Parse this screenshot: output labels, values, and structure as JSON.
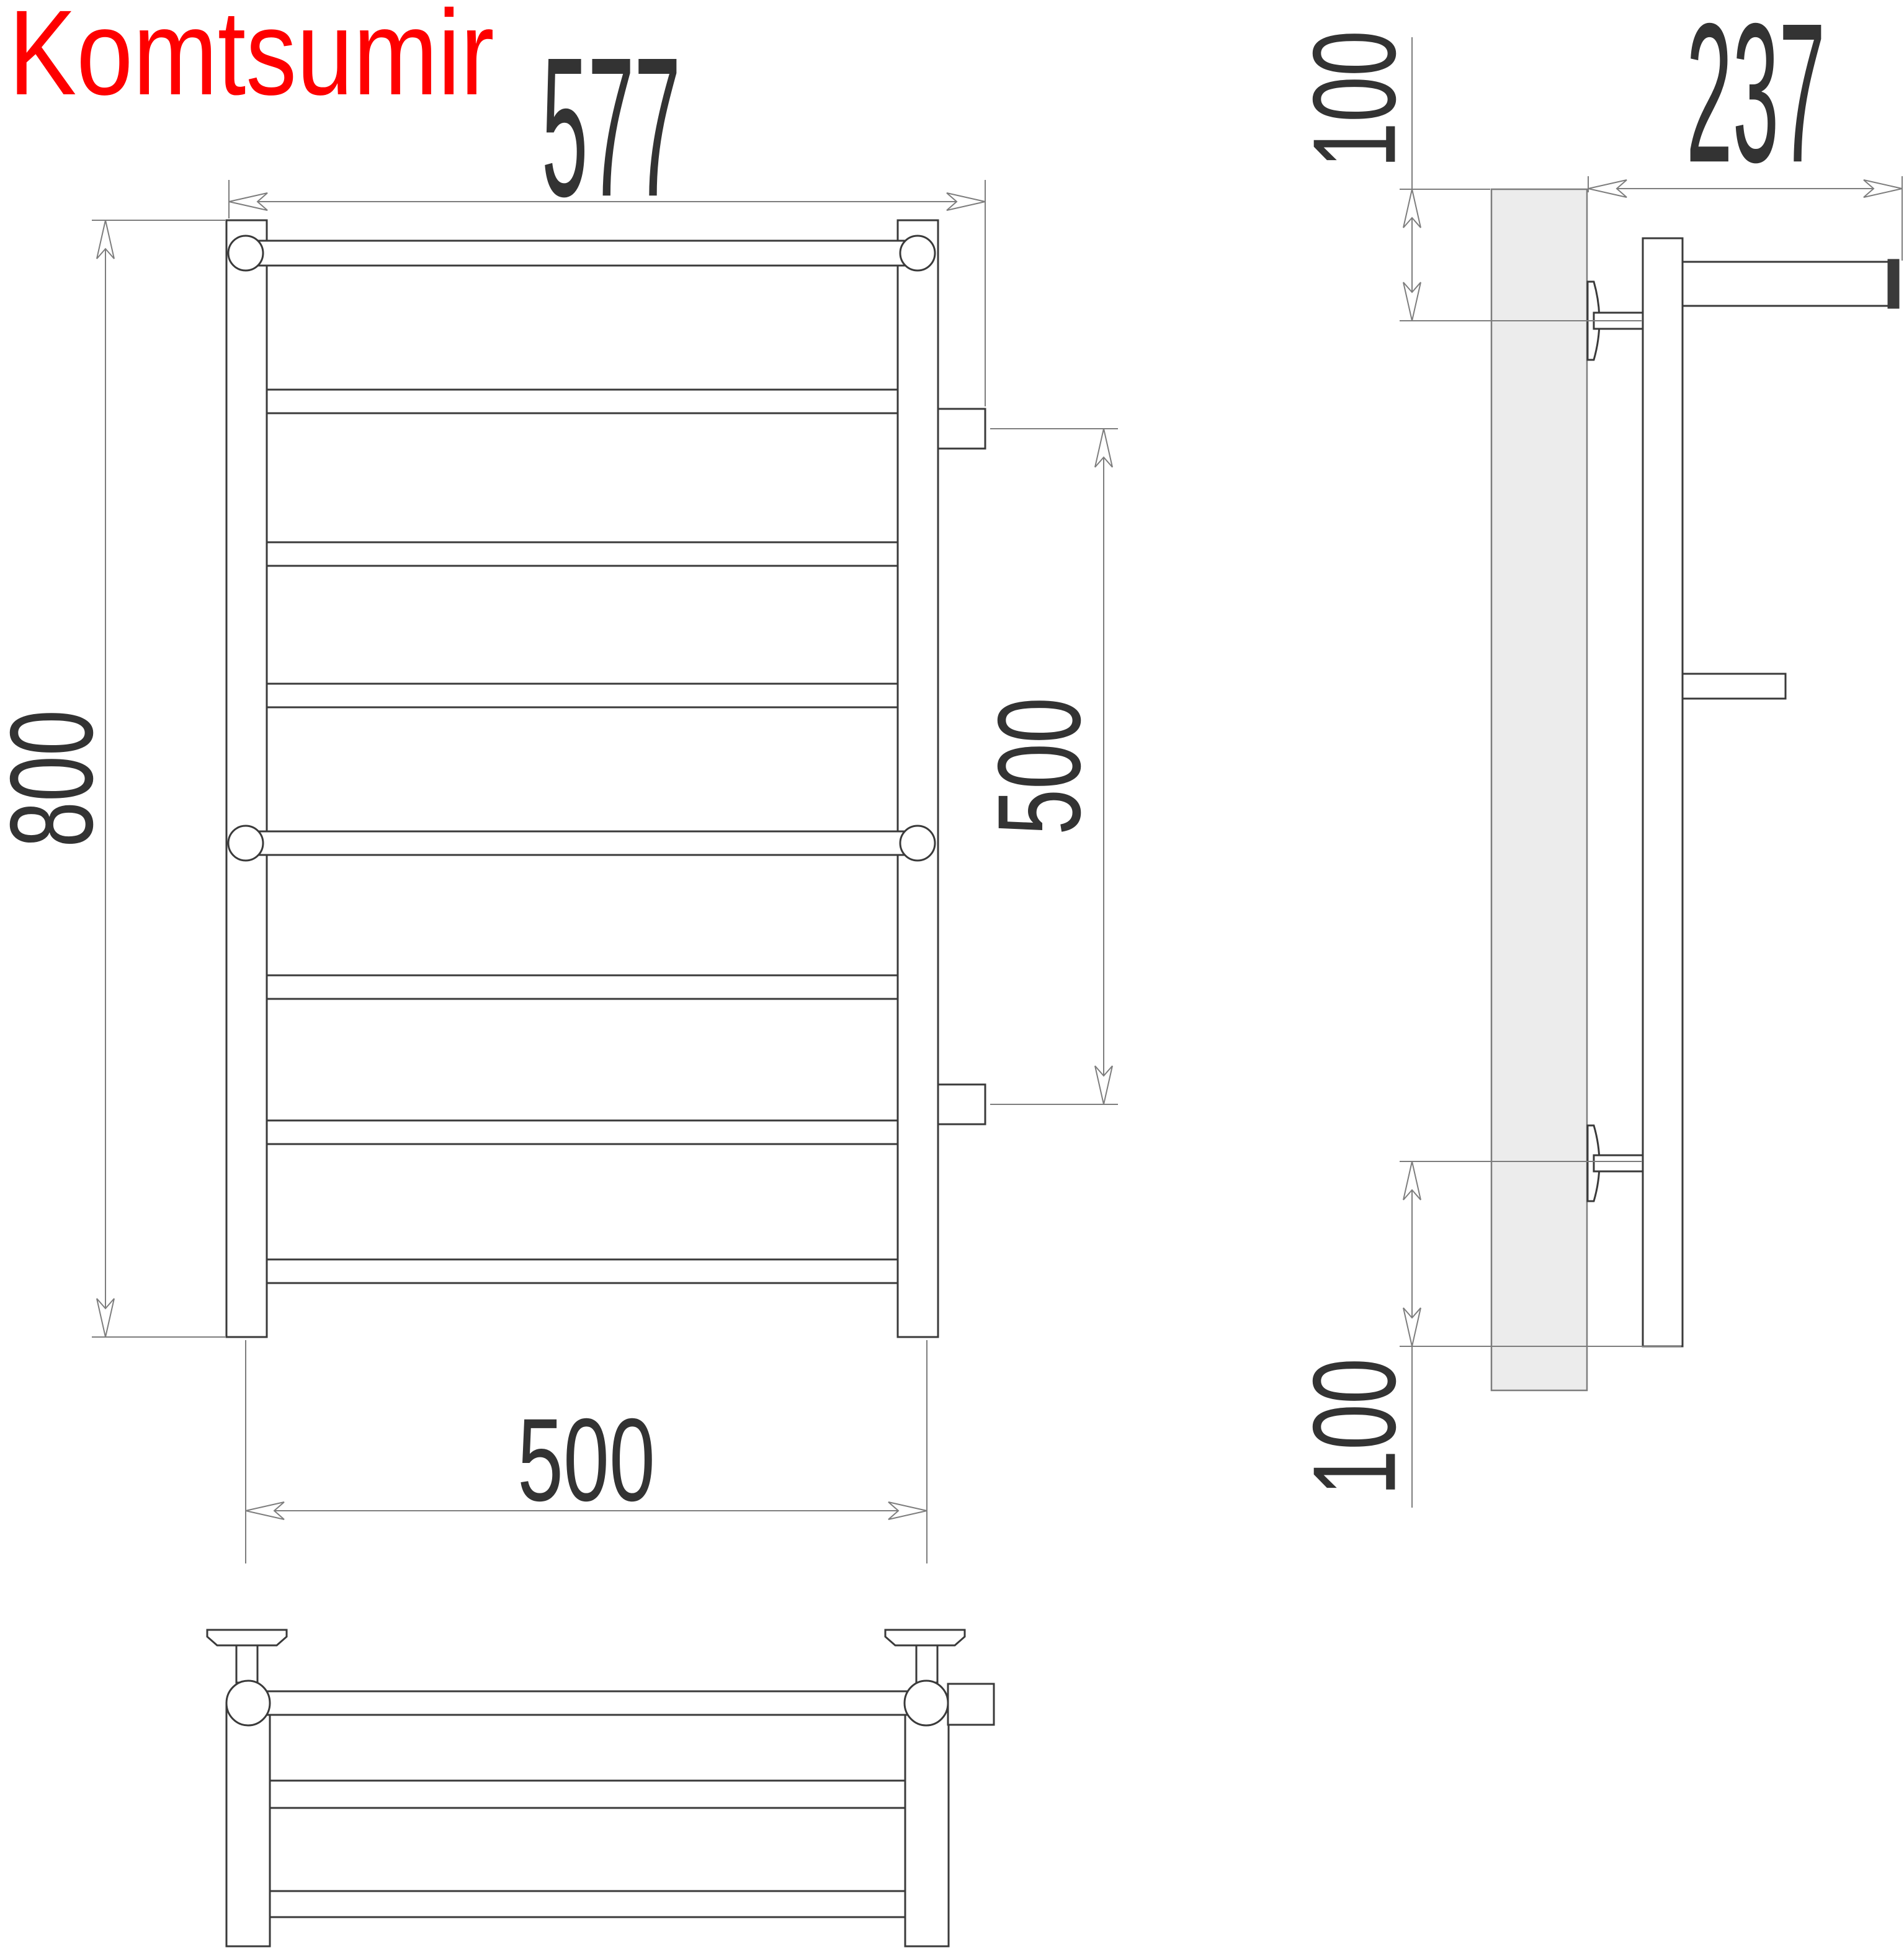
{
  "brand": {
    "text": "Komtsumir",
    "color": "#fe0000"
  },
  "dimensions": {
    "front_overall_width": "577",
    "front_overall_height": "800",
    "right_pipe_spacing": "500",
    "bottom_rail_width": "500",
    "side_depth": "237",
    "side_top_offset": "100",
    "side_bottom_offset": "100"
  },
  "colors": {
    "outline": "#3a3a3a",
    "dimension": "#7d7d7d",
    "text": "#333333",
    "wall_fill": "#ececec",
    "background": "#ffffff"
  }
}
